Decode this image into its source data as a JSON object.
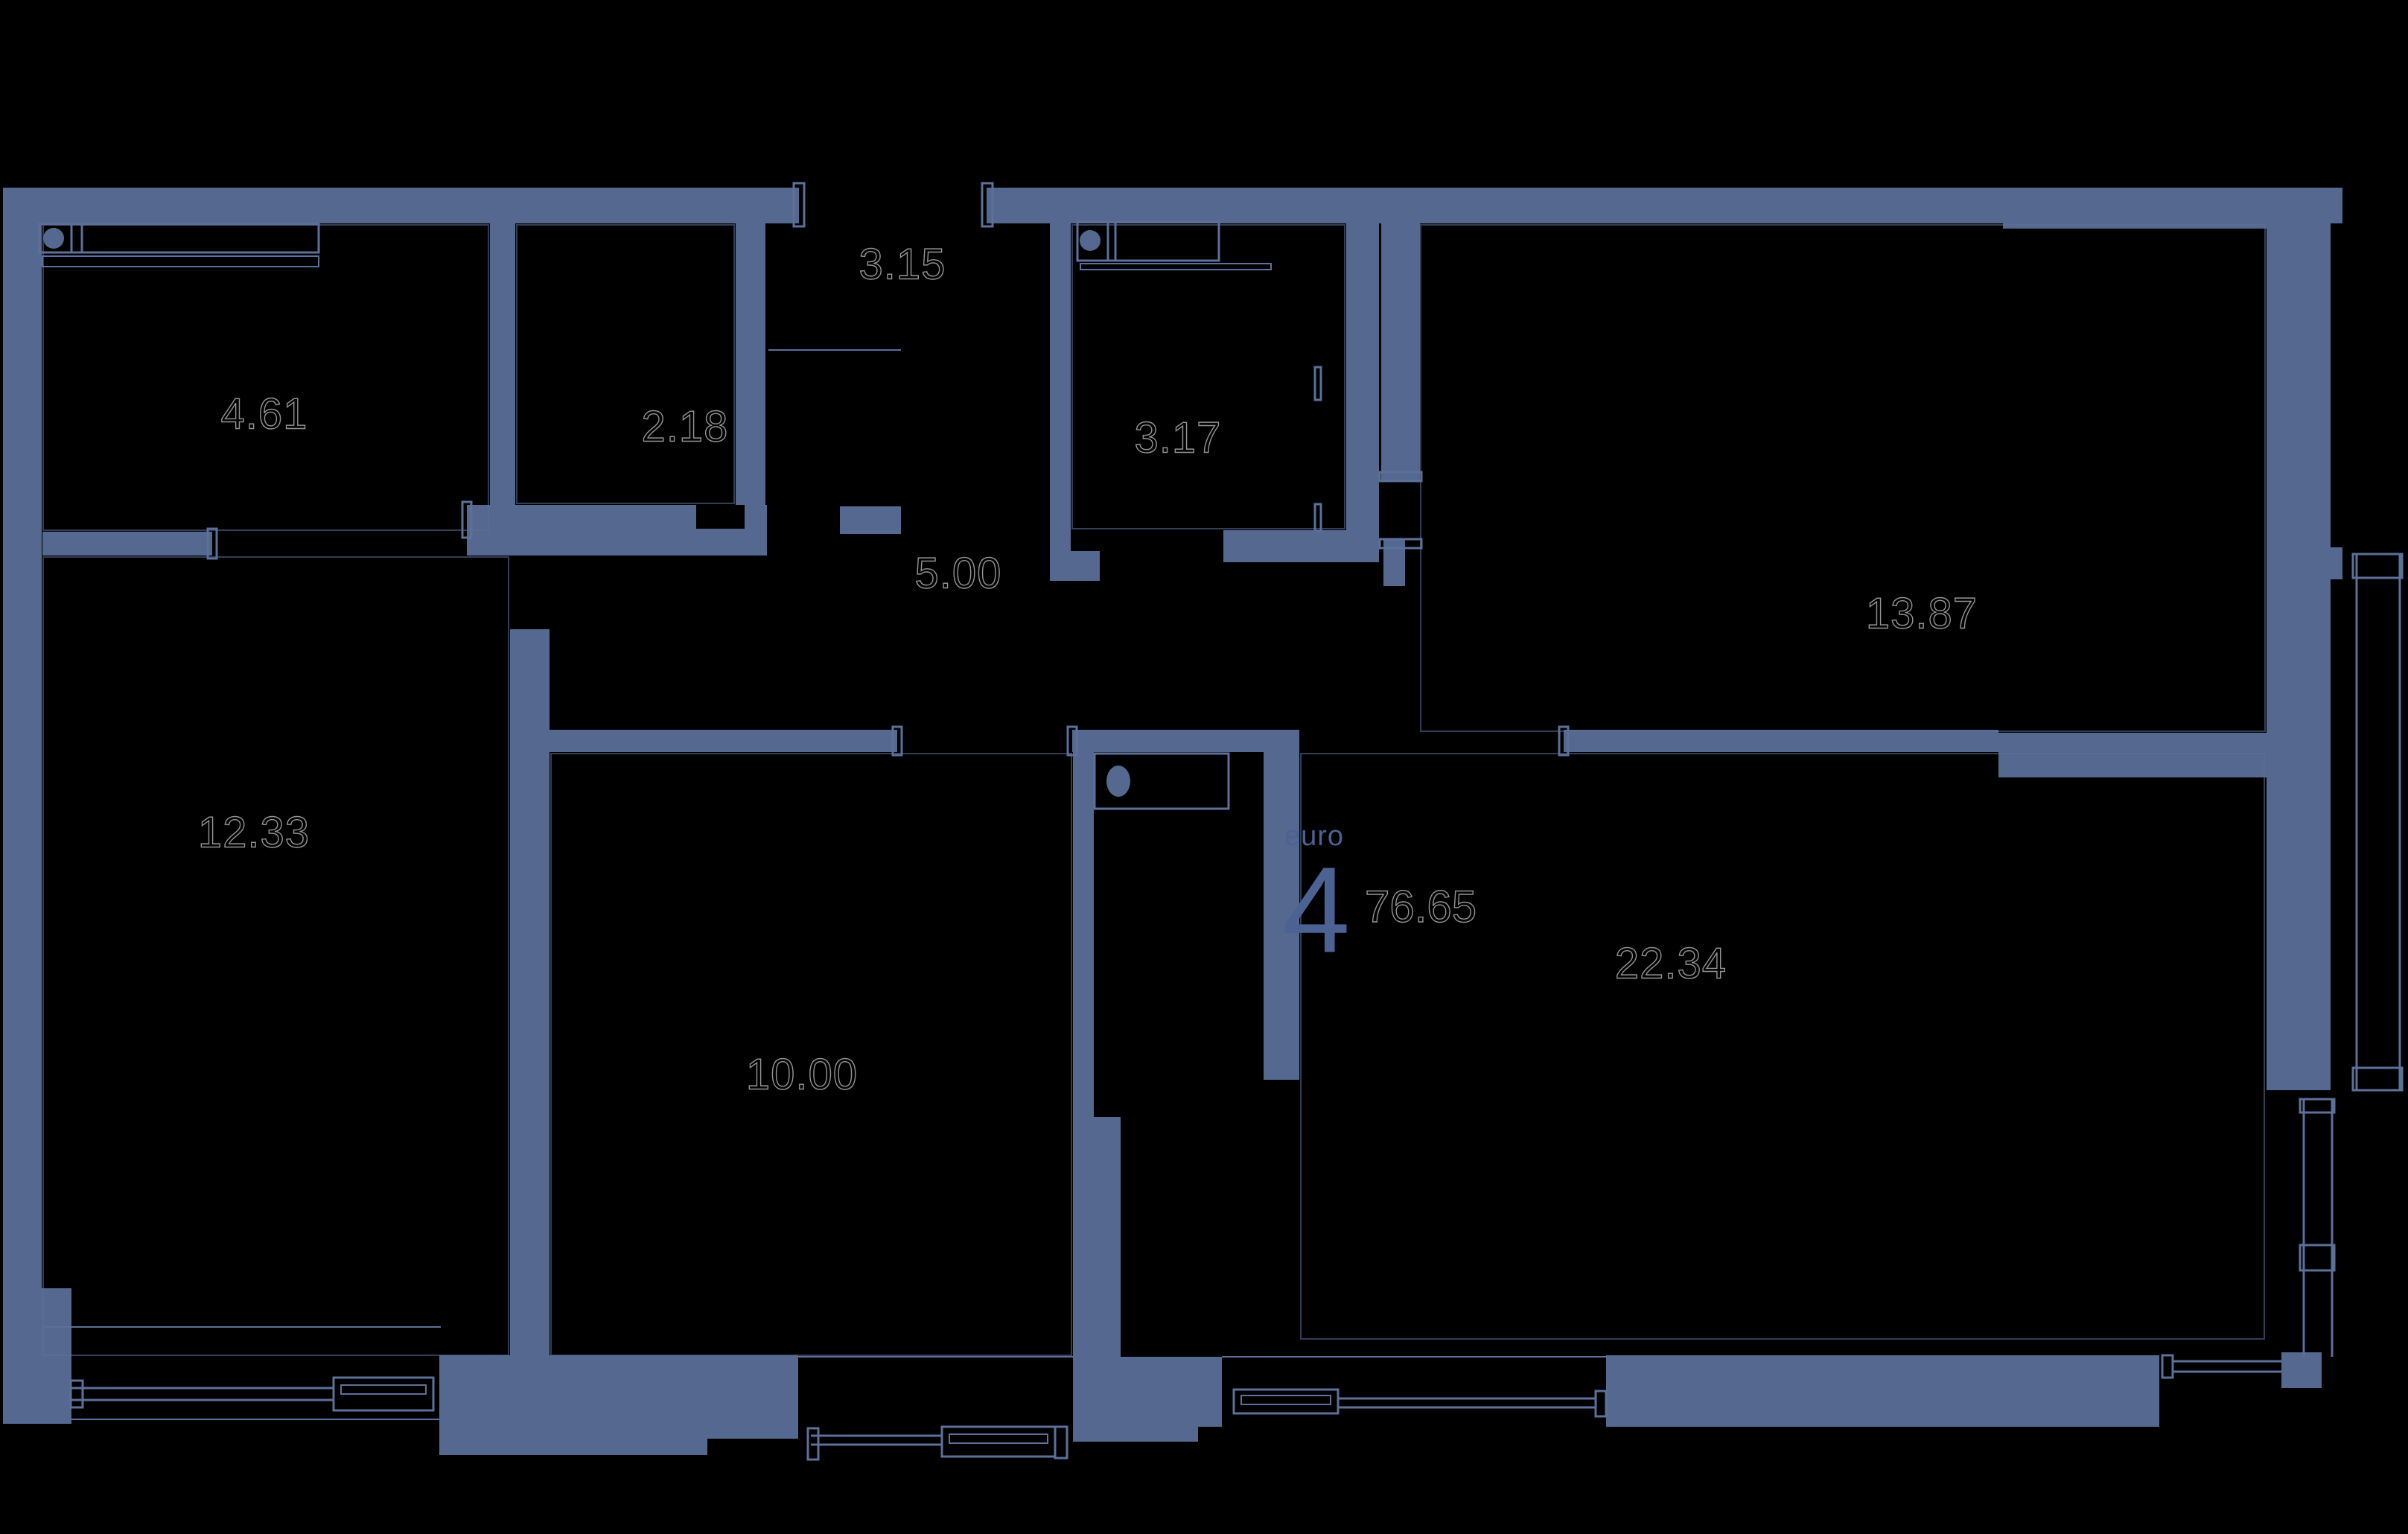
{
  "unit": {
    "type_label": "euro",
    "rooms_count": "4",
    "total_area": "76.65"
  },
  "rooms": [
    {
      "id": "bathroom-top-left",
      "area": "4.61"
    },
    {
      "id": "wardrobe",
      "area": "2.18"
    },
    {
      "id": "shaft-top",
      "area": "3.15"
    },
    {
      "id": "bathroom-center",
      "area": "3.17"
    },
    {
      "id": "hallway",
      "area": "5.00"
    },
    {
      "id": "bedroom-top-right",
      "area": "13.87"
    },
    {
      "id": "bedroom-left",
      "area": "12.33"
    },
    {
      "id": "bedroom-center",
      "area": "10.00"
    },
    {
      "id": "living-kitchen",
      "area": "22.34"
    }
  ],
  "icons": {
    "sink_1": "sink-basin",
    "sink_2": "sink-basin",
    "toilet": "toilet-bowl"
  },
  "colors": {
    "bg": "#000000",
    "wall": "#55688f",
    "line": "#5d7099",
    "numeral": "#949494",
    "accent": "#4b6292"
  }
}
